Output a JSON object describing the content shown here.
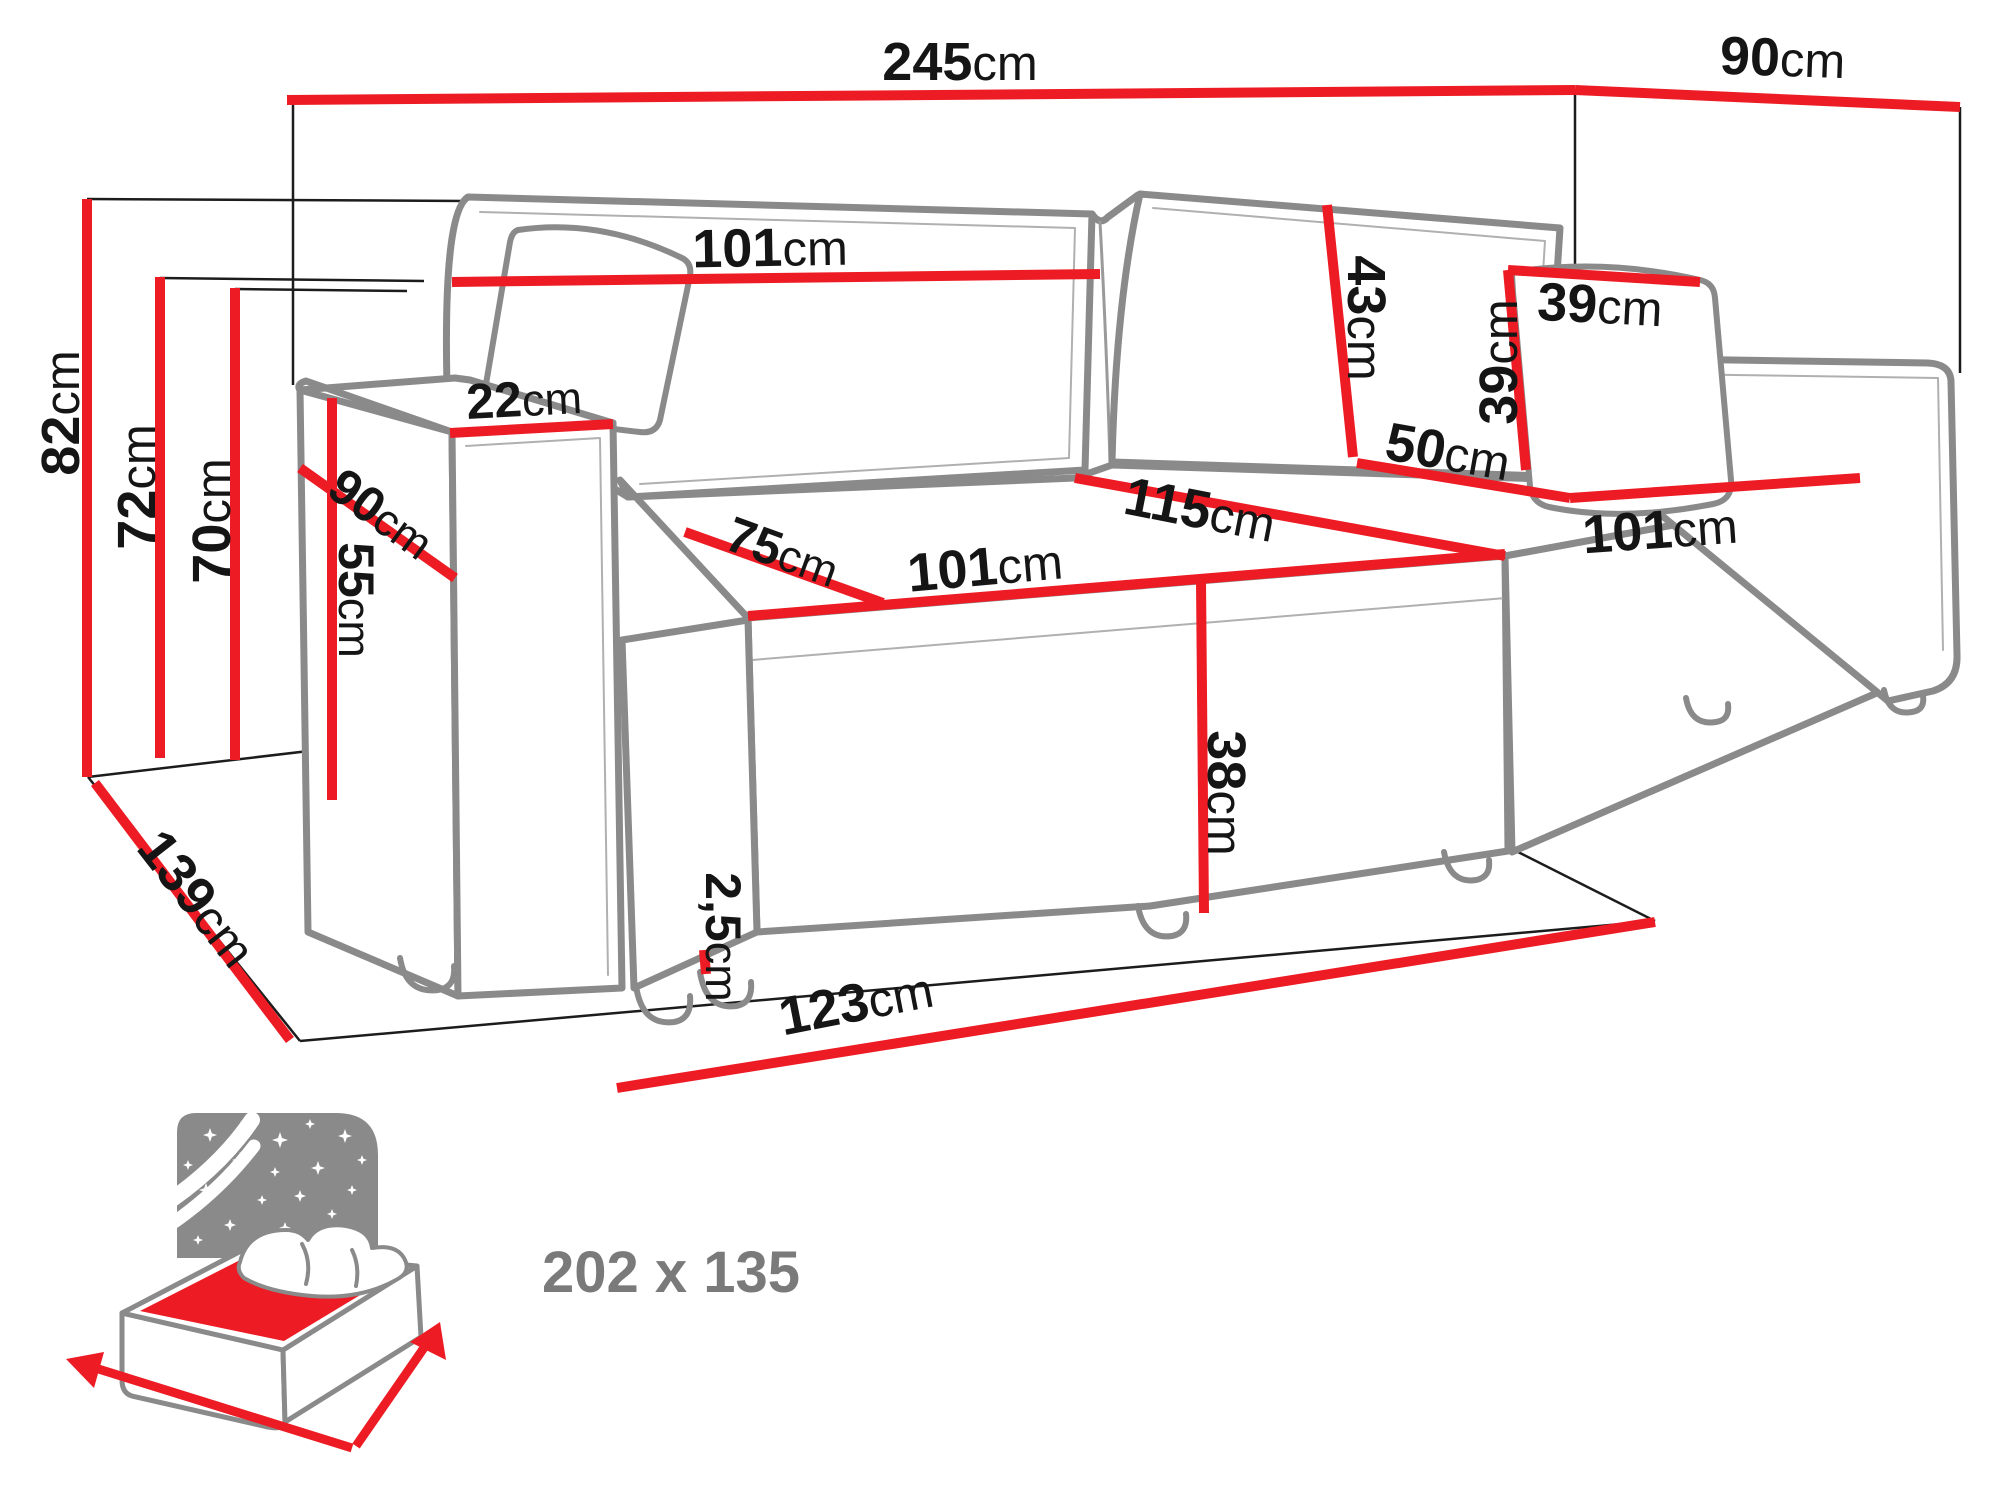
{
  "diagram": {
    "title": "corner-sofa-bed-dimension-drawing",
    "colors": {
      "dimension_line_red": "#ED1C24",
      "sofa_outline_gray": "#8a8a8a",
      "label_black": "#151515",
      "sleeping_label_gray": "#7a7a7a"
    },
    "dimensions": {
      "total_width": {
        "value": "245",
        "unit": "cm"
      },
      "total_depth": {
        "value": "90",
        "unit": "cm"
      },
      "overall_height": {
        "value": "82",
        "unit": "cm"
      },
      "backrest_height": {
        "value": "72",
        "unit": "cm"
      },
      "seat_back_height": {
        "value": "70",
        "unit": "cm"
      },
      "floor_depth": {
        "value": "139",
        "unit": "cm"
      },
      "backrest_width": {
        "value": "101",
        "unit": "cm"
      },
      "armrest_top_width": {
        "value": "22",
        "unit": "cm"
      },
      "armrest_depth": {
        "value": "90",
        "unit": "cm"
      },
      "armrest_height": {
        "value": "55",
        "unit": "cm"
      },
      "back_cushion_height": {
        "value": "43",
        "unit": "cm"
      },
      "pillow_width": {
        "value": "39",
        "unit": "cm"
      },
      "pillow_height": {
        "value": "39",
        "unit": "cm"
      },
      "front_seat_depth": {
        "value": "50",
        "unit": "cm"
      },
      "chaise_depth": {
        "value": "115",
        "unit": "cm"
      },
      "seat_cushion_depth": {
        "value": "75",
        "unit": "cm"
      },
      "seat_width": {
        "value": "101",
        "unit": "cm"
      },
      "chaise_seat_width": {
        "value": "101",
        "unit": "cm"
      },
      "seat_front_height": {
        "value": "38",
        "unit": "cm"
      },
      "leg_height": {
        "value": "2,5",
        "unit": "cm"
      },
      "front_edge_width": {
        "value": "123",
        "unit": "cm"
      }
    },
    "sleeping_area": {
      "label": "202 x 135"
    }
  }
}
